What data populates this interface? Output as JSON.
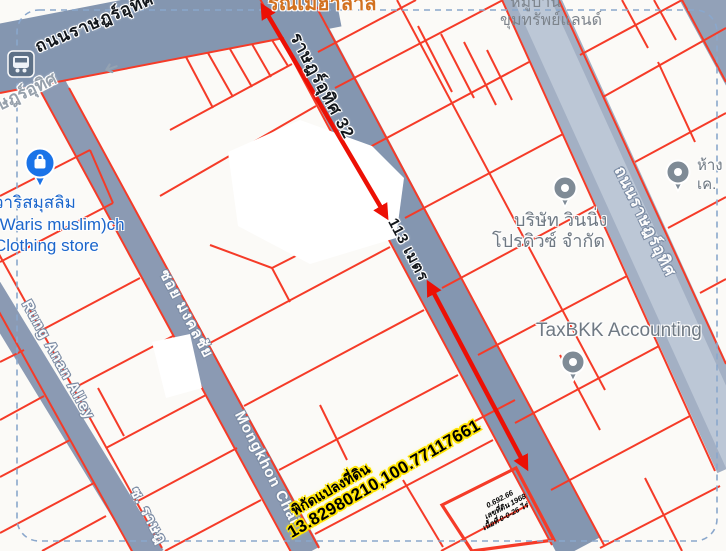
{
  "map": {
    "roads": {
      "main": "ถนนราษฎร์อุทิศ",
      "main_ghost": "ษฎร์อุทิศ",
      "soi32": "ราษฎร์อุทิศ 32",
      "right": "ถนนราษฎร์อุทิศ",
      "soi_mongkhon": "ซอย มงคลชัย",
      "mongkhon_en": "Mongkhon Chai",
      "rung_anan": "Rung Anan Alley",
      "soi_rat_fragment": "ซ. ราษฎ"
    },
    "measurement": {
      "distance": "113 เมตร"
    },
    "plot": {
      "coords_label": "พิกัดแปลงที่ดิน",
      "coords_value": "13.82980210,100.77117661",
      "note1": "0.692.66",
      "note2": "เลขที่ดิน 1968",
      "note3": "เนื้อที่ 0-0-26 ไร่"
    },
    "pois": {
      "halal_fragment": "รณเมฮาลาล",
      "village_line1": "หมู่บ้าน",
      "village_line2": "ขุมทรัพย์แลนด์",
      "waris_line1": "วาริสมุสลิม",
      "waris_line2": "(Waris muslim)ch",
      "waris_line3": "Clothing store",
      "company_line1": "บริษัท วินนิ่ง",
      "company_line2": "โปรดิวซ์ จำกัด",
      "taxbkk": "TaxBKK Accounting",
      "hang_line1": "ห้าง",
      "hang_line2": "เค."
    },
    "icons": [
      "bus-icon",
      "shop-pin-icon",
      "poi-pin-icon",
      "one-way-arrow-icon"
    ],
    "colors": {
      "parcel_line": "#f53b28",
      "road": "#8496b0",
      "road_light": "#aeb9cc",
      "arrow": "#ec1005",
      "boundary_dash": "#8aa7cc",
      "coord_halo": "#ffe400",
      "poi_orange": "#d2711f",
      "poi_blue": "#1b66cc",
      "poi_gray": "#6f7983"
    }
  }
}
